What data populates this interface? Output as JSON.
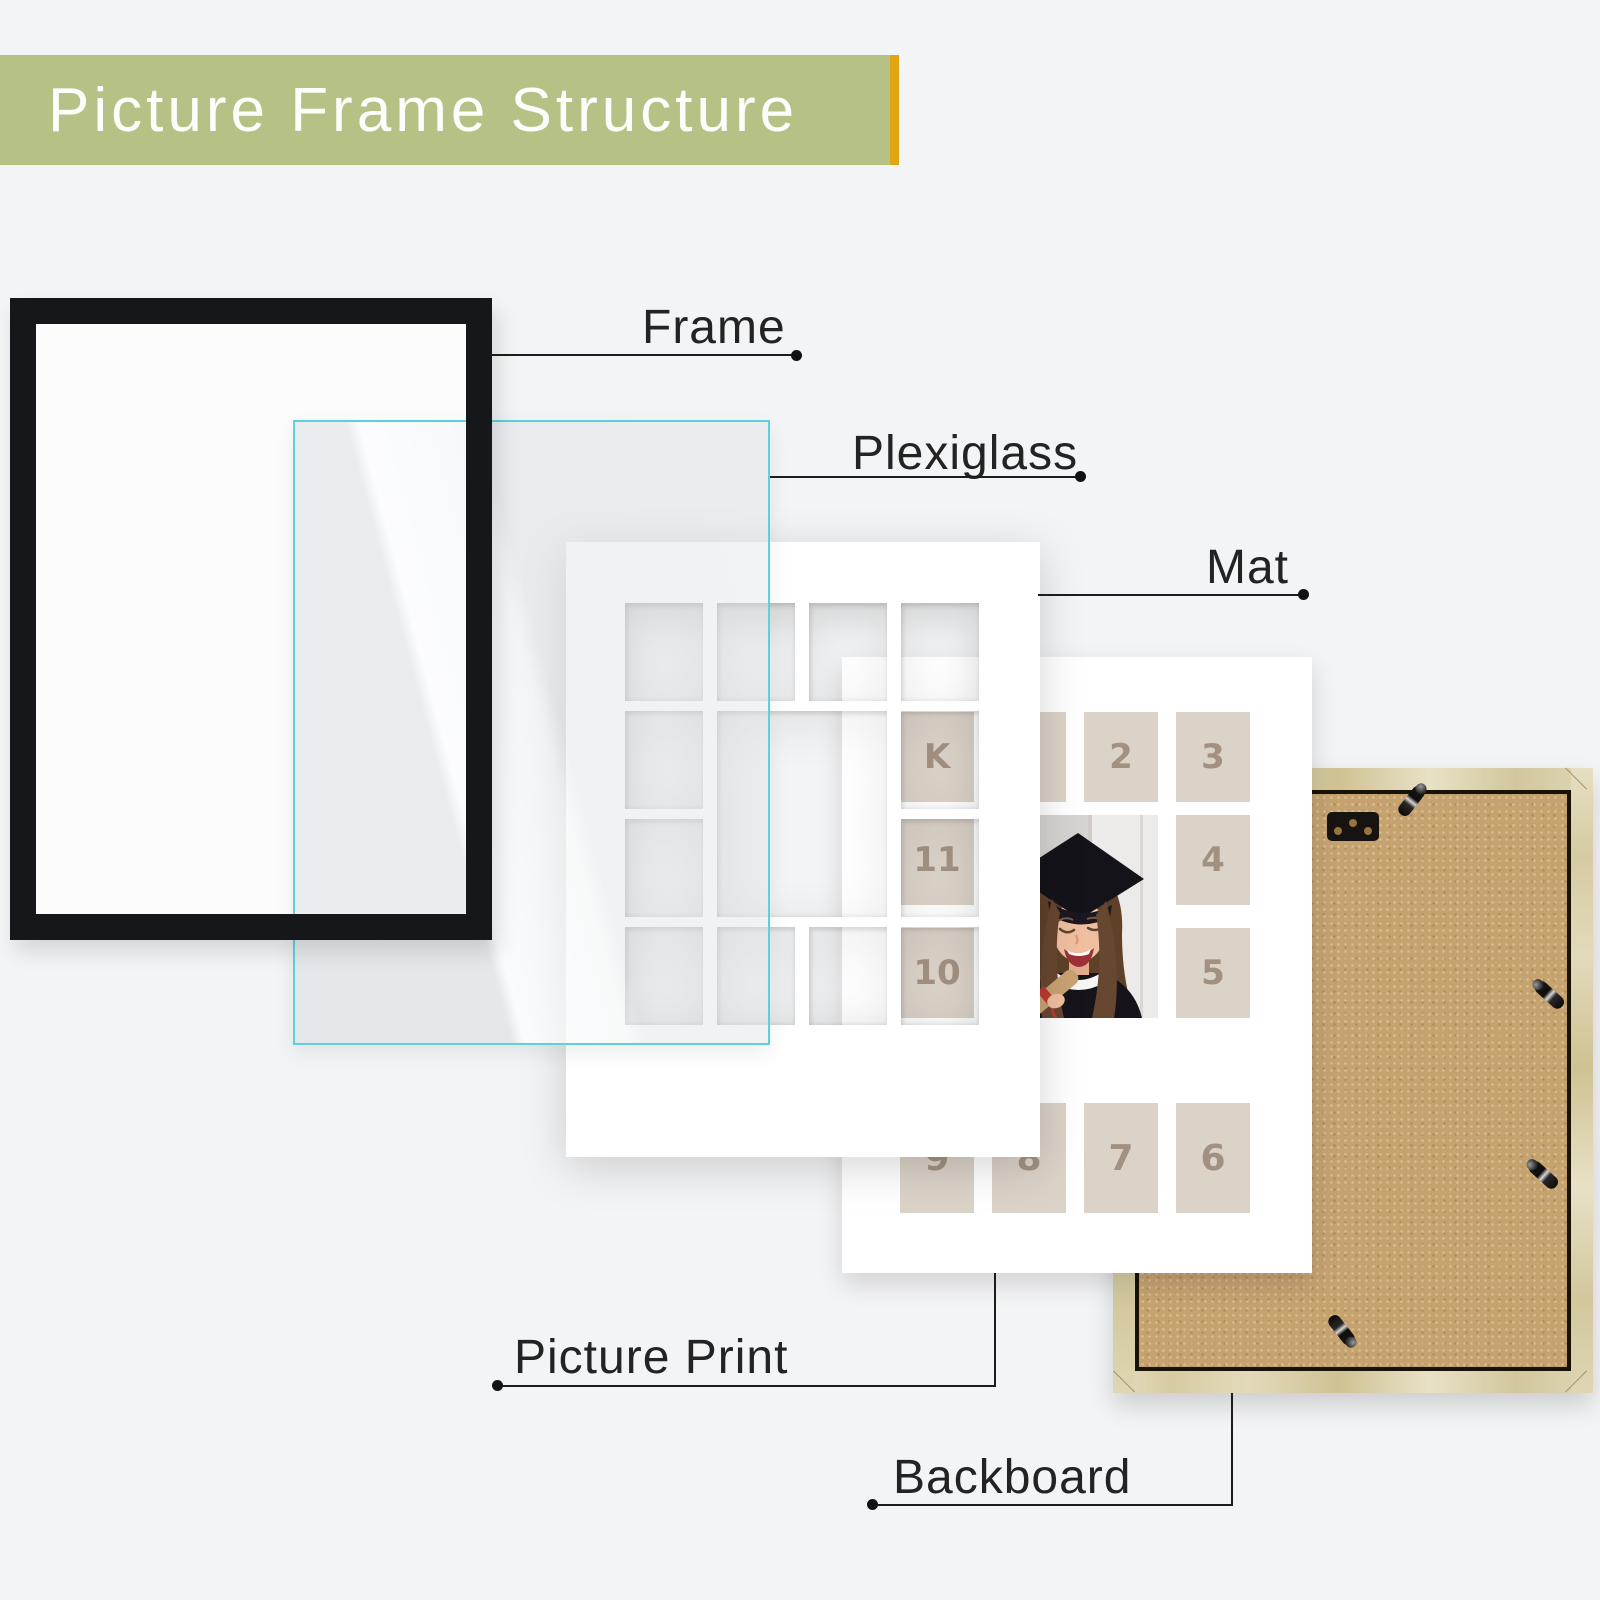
{
  "banner": {
    "title": "Picture Frame Structure",
    "bg_color": "#b6c285",
    "accent_color": "#e2a512"
  },
  "callouts": {
    "frame": "Frame",
    "plexiglass": "Plexiglass",
    "mat": "Mat",
    "picture_print": "Picture Print",
    "backboard": "Backboard"
  },
  "print_cells": [
    "K",
    "1",
    "2",
    "3",
    "11",
    "4",
    "10",
    "5",
    "9",
    "8",
    "7",
    "6"
  ],
  "photo": {
    "name": "graduation-portrait"
  },
  "colors": {
    "page_background": "#f3f4f5",
    "frame_black": "#16171b",
    "plexiglass_border": "#5ecfdf",
    "mat_white": "#ffffff",
    "cell_beige": "#dbd2c8",
    "cell_number": "#a29180",
    "board_kraft": "#c6a26f",
    "wood": "#ddd3ae",
    "callout_line": "#1c1c1c"
  }
}
